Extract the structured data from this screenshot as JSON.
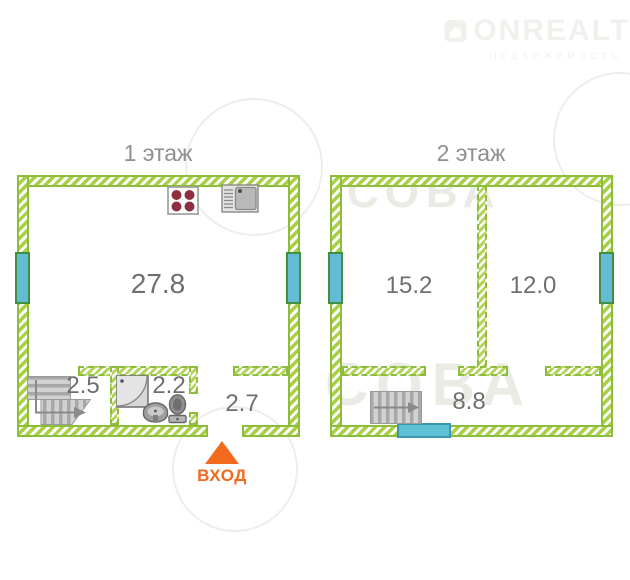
{
  "logo": {
    "brand": "ONREALT",
    "subtitle": "НЕДВИЖИМОСТЬ",
    "icon": "house-icon"
  },
  "watermark": {
    "text": "СОВА"
  },
  "entrance": {
    "label": "ВХОД",
    "color": "#f26a1d"
  },
  "floors": [
    {
      "title": "1 этаж",
      "rooms": [
        {
          "name": "living-room-kitchen",
          "area": "27.8"
        },
        {
          "name": "stairs-room",
          "area": "2.5"
        },
        {
          "name": "bathroom",
          "area": "2.2"
        },
        {
          "name": "hallway",
          "area": "2.7"
        }
      ],
      "fixtures": [
        "stove",
        "kitchen-sink",
        "shower-tray",
        "wash-basin",
        "toilet",
        "l-shaped-stairs"
      ],
      "openings": [
        "window-left",
        "window-right",
        "entrance-door-opening"
      ]
    },
    {
      "title": "2 этаж",
      "rooms": [
        {
          "name": "room-left",
          "area": "15.2"
        },
        {
          "name": "room-right",
          "area": "12.0"
        },
        {
          "name": "hallway",
          "area": "8.8"
        }
      ],
      "fixtures": [
        "straight-stairs"
      ],
      "openings": [
        "window-left",
        "window-right",
        "balcony-door"
      ]
    }
  ],
  "colors": {
    "wall_hatch": "#a9cf44",
    "wall_border": "#8cbd3c",
    "window_fill": "#63bcd4",
    "window_border": "#3f9140",
    "balcony_door": "#5fc0d6",
    "entrance_orange": "#f26a1d",
    "label_gray": "#6f6f6f",
    "fixture_gray": "#c9c9c9",
    "burner_red": "#8e2f40"
  }
}
